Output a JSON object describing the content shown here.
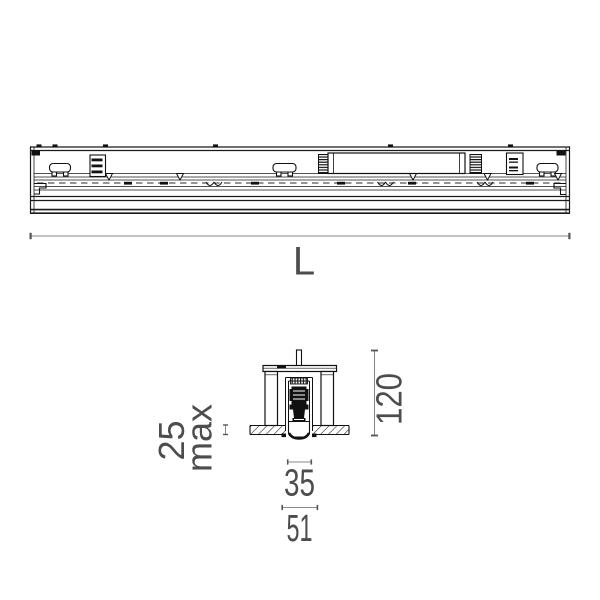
{
  "drawing": {
    "type": "luminaire-technical-drawing",
    "colors": {
      "line": "#1a1a1a",
      "dim_line": "#8a8a8a",
      "dim_tick": "#555555",
      "dim_text": "#4d4d4d",
      "background": "#ffffff"
    },
    "dimensions": {
      "length": {
        "label": "L"
      },
      "height": {
        "value": "120"
      },
      "recess": {
        "value": "25",
        "qualifier": "max"
      },
      "body_width": {
        "value": "35"
      },
      "cutout_width": {
        "value": "51"
      }
    }
  }
}
